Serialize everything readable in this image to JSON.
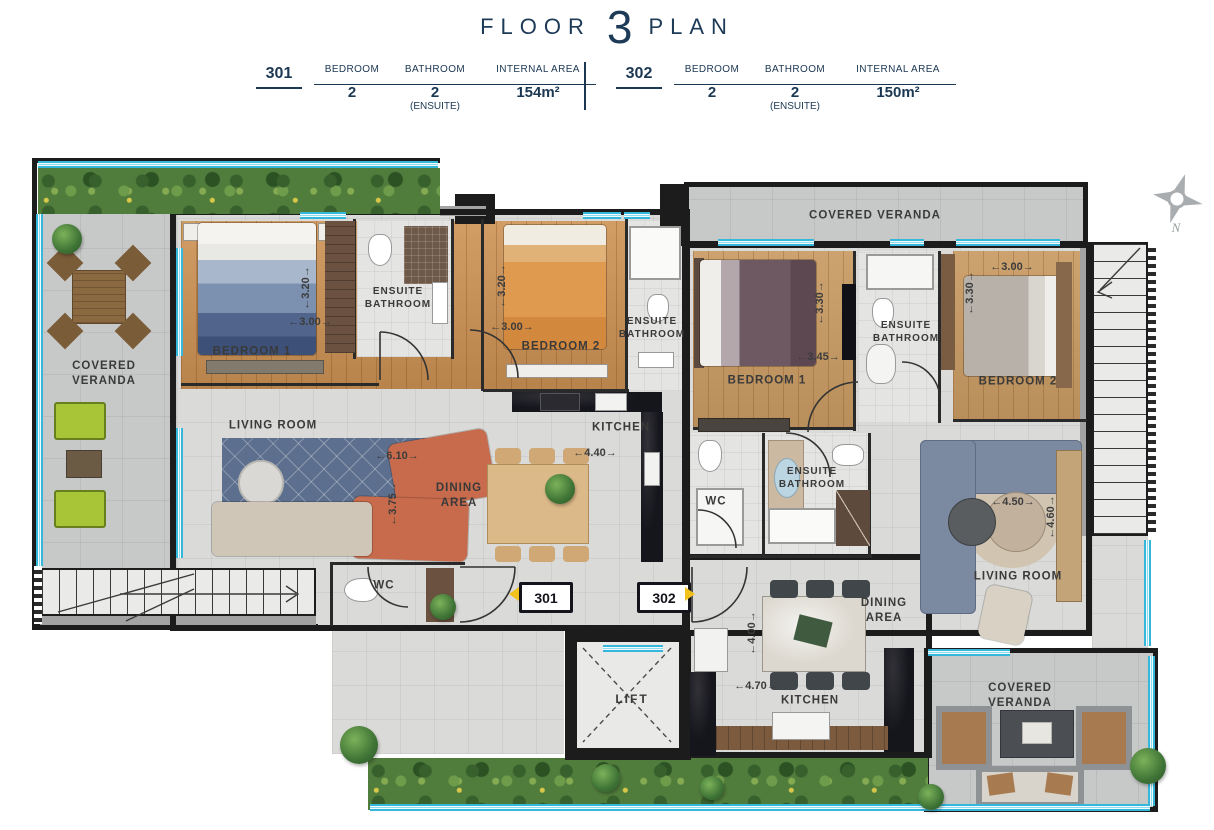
{
  "title": {
    "word1": "FLOOR",
    "number": "3",
    "word2": "PLAN"
  },
  "spec": {
    "units": [
      {
        "id": "301",
        "cols": [
          {
            "h": "BEDROOM",
            "v": "2",
            "note": ""
          },
          {
            "h": "BATHROOM",
            "v": "2",
            "note": "(ENSUITE)"
          },
          {
            "h": "INTERNAL AREA",
            "v": "154m²",
            "note": ""
          }
        ]
      },
      {
        "id": "302",
        "cols": [
          {
            "h": "BEDROOM",
            "v": "2",
            "note": ""
          },
          {
            "h": "BATHROOM",
            "v": "2",
            "note": "(ENSUITE)"
          },
          {
            "h": "INTERNAL AREA",
            "v": "150m²",
            "note": ""
          }
        ]
      }
    ]
  },
  "plan": {
    "compass_n": "N",
    "lift": "LIFT",
    "badge_301": "301",
    "badge_302": "302",
    "verandas": {
      "left": "COVERED VERANDA",
      "top_302": "COVERED VERANDA",
      "bottom_302": "COVERED VERANDA"
    },
    "u301": {
      "bedroom1": "BEDROOM 1",
      "bedroom1_w": "←3.00→",
      "bedroom1_h": "←3.20→",
      "ensuite1": "ENSUITE BATHROOM",
      "bedroom2": "BEDROOM 2",
      "bedroom2_w": "←3.00→",
      "bedroom2_h": "←3.20→",
      "ensuite2": "ENSUITE BATHROOM",
      "living": "LIVING ROOM",
      "living_w": "←6.10→",
      "living_h": "←3.75→",
      "dining": "DINING AREA",
      "kitchen": "KITCHEN",
      "kitchen_w": "←4.40→",
      "wc": "WC"
    },
    "u302": {
      "bedroom1": "BEDROOM 1",
      "bedroom1_w": "←3.45→",
      "bedroom1_h": "←3.30→",
      "ensuite1": "ENSUITE BATHROOM",
      "bedroom2": "BEDROOM 2",
      "bedroom2_w": "←3.00→",
      "bedroom2_h": "←3.30→",
      "wc": "WC",
      "ensuite2": "ENSUITE BATHROOM",
      "living": "LIVING ROOM",
      "living_w": "←4.50→",
      "living_h": "←4.60→",
      "dining": "DINING AREA",
      "kitchen": "KITCHEN",
      "kitchen_w": "←4.70→",
      "kitchen_h": "←4.00→"
    }
  }
}
